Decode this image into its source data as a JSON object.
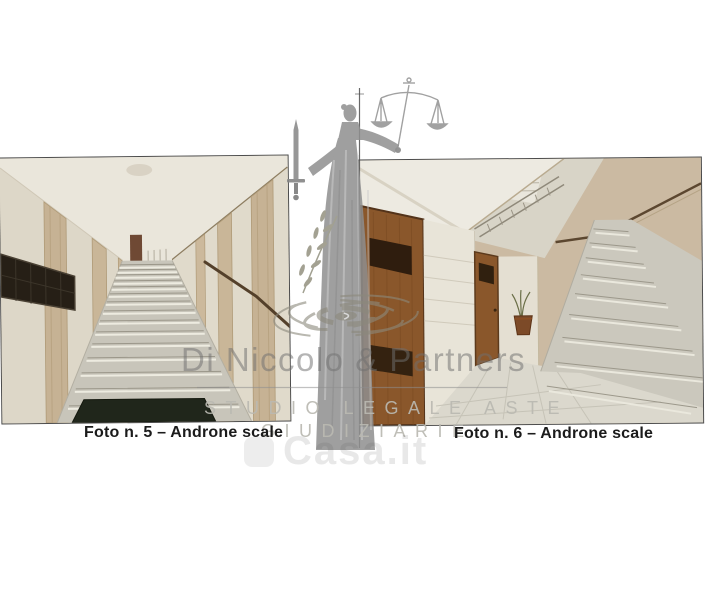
{
  "page": {
    "type": "auction photo sheet with two labeled photographs",
    "background_color": "#ffffff"
  },
  "photos": [
    {
      "id": "foto-5",
      "caption": "Foto n. 5 – Androne scale",
      "description": "Corridoio d'ingresso con lunga scalinata in marmo, cassette postali scure a sinistra, lesene beige e zerbino scuro",
      "border_color": "#3c3c3c"
    },
    {
      "id": "foto-6",
      "caption": "Foto n. 6 – Androne scale",
      "description": "Androne con porte in legno marrone, pavimento piastrellato chiaro, piantina e scala in marmo a destra",
      "border_color": "#3c3c3c"
    }
  ],
  "watermark": {
    "firm_name": "Di Niccolo & Partners",
    "subtitle_line1": "STUDIO LEGALE ASTE",
    "subtitle_line2": "GIUDIZIARIE",
    "portal_name": "Casa.it",
    "figure_icon": "lady-justice-with-scales-and-sword",
    "logo_icon": "ripple-ellipse-monogram",
    "text_color": "#8f8f8f"
  },
  "colors": {
    "caption_text": "#1b1b1b",
    "watermark_gray": "#8f8f8f",
    "divider_line": "#4e4e4e"
  }
}
